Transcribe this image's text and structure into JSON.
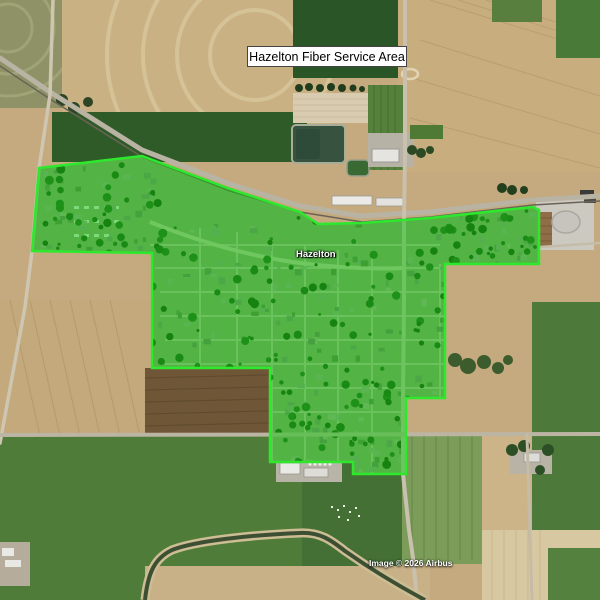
{
  "header": {
    "title": "Hazelton Fiber Service Area"
  },
  "map": {
    "town_label": "Hazelton",
    "attribution": "Image © 2026 Airbus",
    "overlay": {
      "label": "Hazelton fiber service area polygon",
      "fill": "#00cc00",
      "fill_opacity": "0.45",
      "stroke": "#2ee82e",
      "stroke_width": "2.5",
      "points": "39,168 142,156 230,189 300,212 318,224 362,223 430,218 533,207 539,210 539,264 445,264 445,398 406,398 406,474 353,474 353,462 270,462 270,368 152,368 152,253 32,251"
    }
  }
}
